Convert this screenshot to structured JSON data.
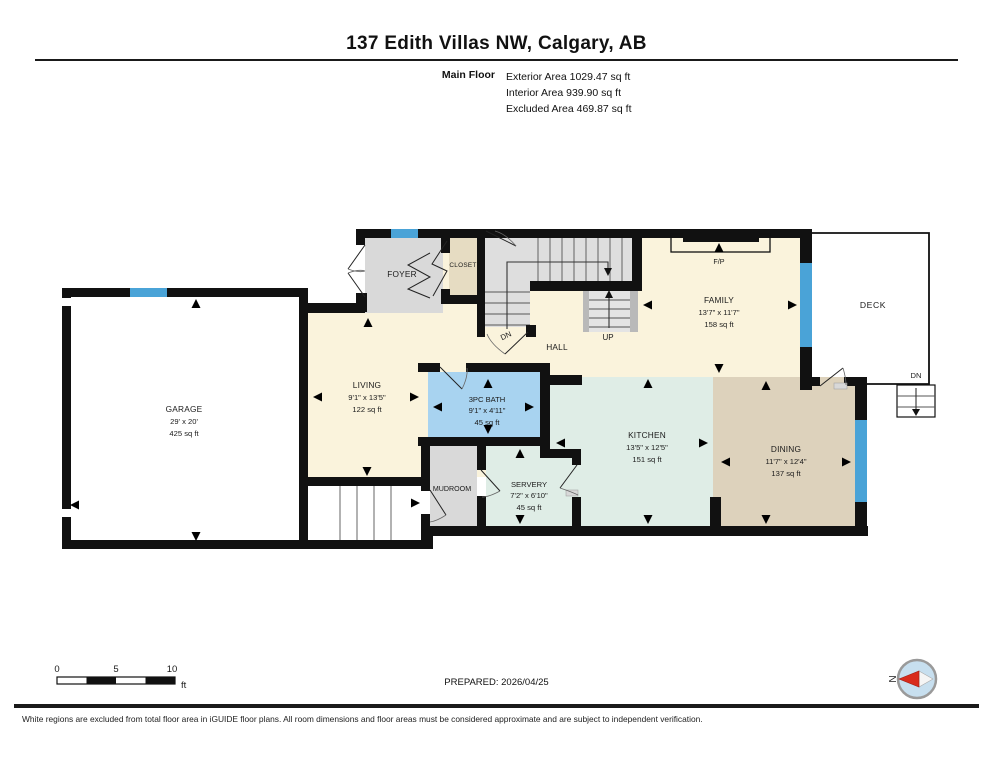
{
  "header": {
    "title": "137 Edith Villas NW, Calgary, AB",
    "floor_label": "Main Floor",
    "areas": [
      "Exterior Area 1029.47 sq ft",
      "Interior Area 939.90 sq ft",
      "Excluded Area 469.87 sq ft"
    ]
  },
  "plan": {
    "rooms": {
      "garage": {
        "name": "GARAGE",
        "dims": "29' x 20'",
        "area": "425 sq ft"
      },
      "living": {
        "name": "LIVING",
        "dims": "9'1\" x 13'5\"",
        "area": "122 sq ft"
      },
      "bath": {
        "name": "3PC BATH",
        "dims": "9'1\" x 4'11\"",
        "area": "45 sq ft"
      },
      "servery": {
        "name": "SERVERY",
        "dims": "7'2\" x 6'10\"",
        "area": "45 sq ft"
      },
      "kitchen": {
        "name": "KITCHEN",
        "dims": "13'5\" x 12'5\"",
        "area": "151 sq ft"
      },
      "dining": {
        "name": "DINING",
        "dims": "11'7\" x 12'4\"",
        "area": "137 sq ft"
      },
      "family": {
        "name": "FAMILY",
        "dims": "13'7\" x 11'7\"",
        "area": "158 sq ft"
      },
      "foyer": {
        "name": "FOYER"
      },
      "closet": {
        "name": "CLOSET"
      },
      "mudroom": {
        "name": "MUDROOM"
      },
      "hall": {
        "name": "HALL"
      },
      "deck": {
        "name": "DECK"
      }
    },
    "stairs": {
      "up_label": "UP",
      "down_label": "DN",
      "deck_down_label": "DN"
    },
    "fireplace_label": "F/P"
  },
  "scale_bar": {
    "tick_0": "0",
    "tick_5": "5",
    "tick_10": "10",
    "unit": "ft"
  },
  "compass": {
    "north_label": "N"
  },
  "footer": {
    "prepared": "PREPARED: 2026/04/25",
    "disclaimer": "White regions are excluded from total floor area in iGUIDE floor plans. All room dimensions and floor areas must be considered approximate and are subject to independent verification."
  },
  "colors": {
    "wall": "#111111",
    "window": "#4AA3D7",
    "floor_cream": "#FAF3DC",
    "floor_mint": "#DFEDE6",
    "floor_tan": "#DDD2BC",
    "floor_blue": "#A8D3F0",
    "floor_gray": "#D9D9D9",
    "floor_closet": "#E6DCC2",
    "stair_gray": "#DEDEDE",
    "compass_red": "#D92B1C",
    "compass_blue": "#C7DFEF"
  }
}
